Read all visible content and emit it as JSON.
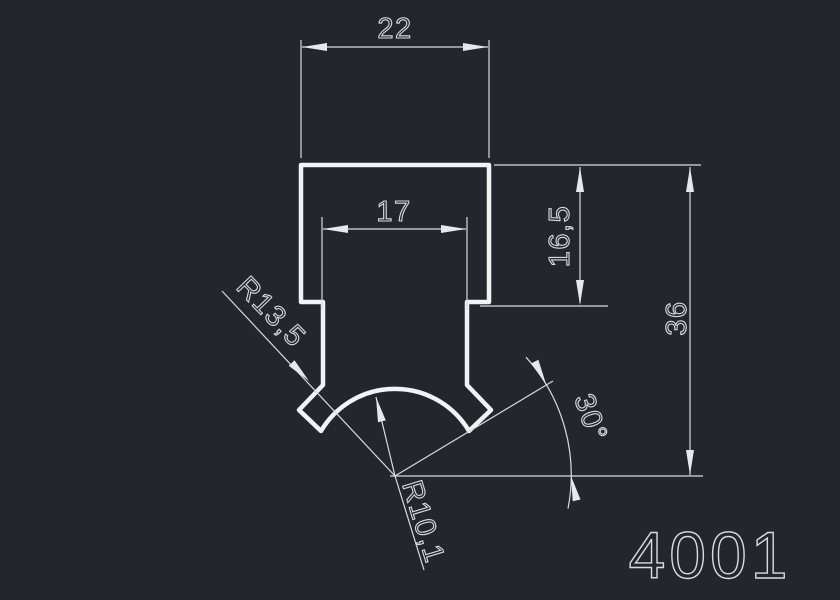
{
  "canvas": {
    "background_color": "#23272d",
    "profile_line_color": "#f2f3f5",
    "dimension_line_color": "#d9dbdd"
  },
  "drawing": {
    "part_number": "4001",
    "dimensions": {
      "width_outer": "22",
      "width_inner": "17",
      "depth_inner": "16,5",
      "height_total": "36",
      "radius_outer": "R13,5",
      "radius_inner": "R10,1",
      "angle": "30°"
    }
  }
}
